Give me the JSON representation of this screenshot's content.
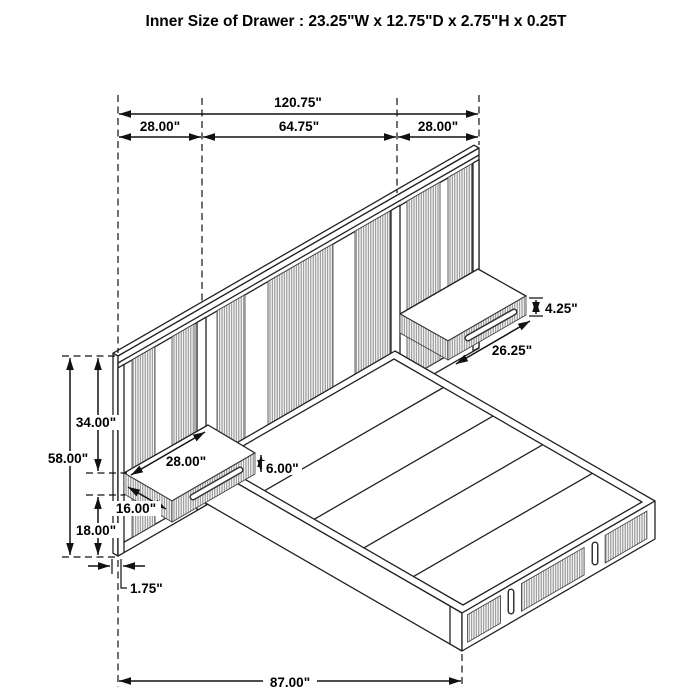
{
  "title": "Inner Size of Drawer : 23.25\"W x 12.75\"D x 2.75\"H x 0.25T",
  "dims": {
    "total_width": "120.75\"",
    "left_section_width": "28.00\"",
    "center_section_width": "64.75\"",
    "right_section_width": "28.00\"",
    "headboard_height": "58.00\"",
    "headboard_upper_height": "34.00\"",
    "headboard_lower_height": "18.00\"",
    "panel_thickness": "1.75\"",
    "left_nightstand_width": "28.00\"",
    "left_nightstand_depth": "16.00\"",
    "left_nightstand_height": "6.00\"",
    "right_nightstand_width": "26.25\"",
    "right_nightstand_height": "4.25\"",
    "bed_length": "87.00\""
  },
  "colors": {
    "line": "#222222",
    "dimension": "#111111",
    "rib_fill": "#8a8a8a",
    "background": "#ffffff"
  }
}
